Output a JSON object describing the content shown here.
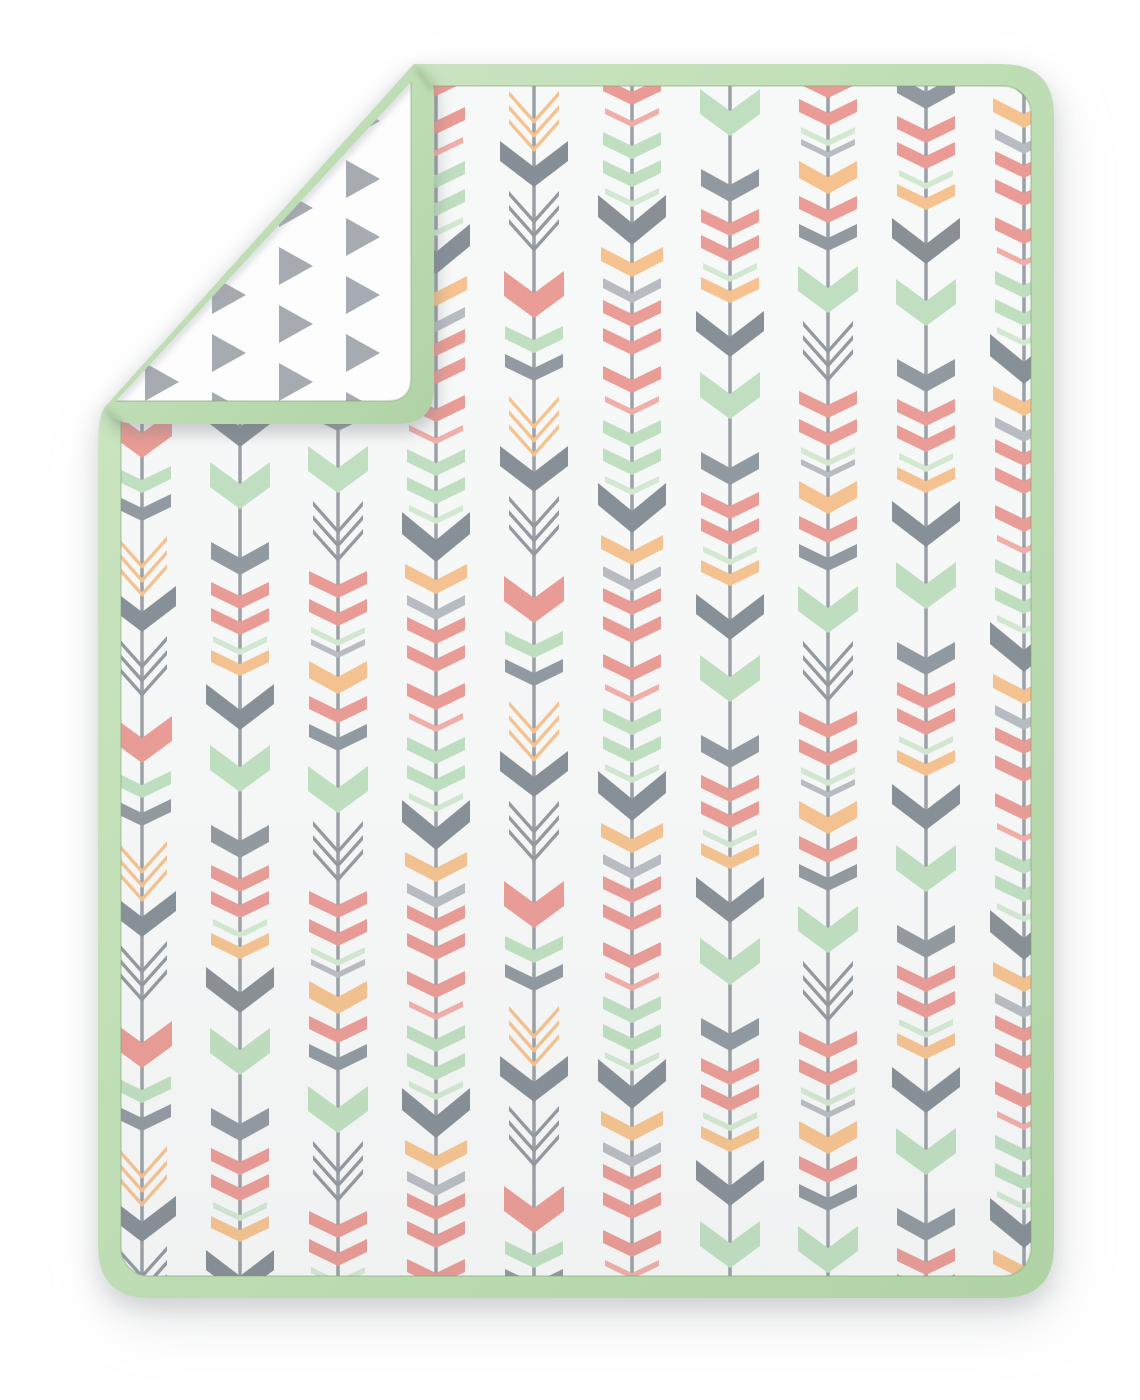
{
  "scene": {
    "background_color": "#ffffff",
    "blanket": {
      "binding_color_light": "#CEE7C4",
      "binding_color_mid": "#BEDDB4",
      "binding_color_dark": "#B0D3A6",
      "binding_seam_color": "rgba(125,155,115,0.30)",
      "front_fabric_color": "#F7F8F8",
      "front_fabric_shade": "rgba(120,126,132,0.05)",
      "back_fabric_color": "#FDFDFE",
      "crease_shadow_color": "rgba(148,154,160,0.28)",
      "fold_notch_color": "rgba(95,115,90,0.40)"
    },
    "front_pattern": {
      "shaft_color": "#9AA0A6",
      "shaft_width": 3.5,
      "palette": {
        "coral": "#EA9B95",
        "coralLine": "#F1AEA8",
        "mint": "#BFDFC0",
        "mintLine": "#D2E8D1",
        "gray": "#9199A0",
        "grayBig": "#878F96",
        "grayLight": "#B7BCC2",
        "peach": "#F5C28F"
      },
      "pattern_area": {
        "top": 86,
        "bottom": 1276
      },
      "sequences": {
        "A": {
          "period": 283,
          "motifs": [
            [
              0,
              60,
              22,
              25,
              "mint"
            ],
            [
              80,
              58,
              16,
              17,
              "gray"
            ],
            [
              120,
              58,
              14,
              13,
              "coral"
            ],
            [
              146,
              58,
              14,
              13,
              "coral"
            ],
            [
              174,
              54,
              13,
              6,
              "mintLine"
            ],
            [
              188,
              58,
              14,
              12,
              "peach"
            ],
            [
              222,
              68,
              26,
              20,
              "grayBig"
            ]
          ]
        },
        "B": {
          "period": 288,
          "motifs": [
            [
              0,
              68,
              28,
              22,
              "grayBig"
            ],
            [
              52,
              62,
              16,
              14,
              "peach"
            ],
            [
              83,
              58,
              15,
              10,
              "grayLight"
            ],
            [
              105,
              58,
              14,
              13,
              "coral"
            ],
            [
              133,
              58,
              14,
              13,
              "coral"
            ],
            [
              171,
              58,
              14,
              13,
              "coral"
            ],
            [
              201,
              54,
              13,
              6,
              "coralLine"
            ],
            [
              225,
              58,
              14,
              13,
              "mint"
            ],
            [
              253,
              58,
              14,
              13,
              "mint"
            ],
            [
              281,
              54,
              13,
              6,
              "mintLine"
            ]
          ]
        },
        "C": {
          "period": 305,
          "motifs": [
            [
              0,
              50,
              28,
              5,
              "gray"
            ],
            [
              14,
              50,
              28,
              5,
              "gray"
            ],
            [
              28,
              50,
              28,
              5,
              "gray"
            ],
            [
              80,
              60,
              22,
              25,
              "coral"
            ],
            [
              135,
              58,
              14,
              13,
              "mint"
            ],
            [
              163,
              58,
              14,
              13,
              "gray"
            ],
            [
              205,
              50,
              28,
              5,
              "peach"
            ],
            [
              219,
              50,
              28,
              5,
              "peach"
            ],
            [
              233,
              50,
              28,
              5,
              "peach"
            ],
            [
              255,
              68,
              26,
              20,
              "grayBig"
            ]
          ]
        },
        "D": {
          "period": 320,
          "motifs": [
            [
              0,
              58,
              14,
              13,
              "coral"
            ],
            [
              28,
              58,
              14,
              13,
              "gray"
            ],
            [
              70,
              60,
              22,
              25,
              "mint"
            ],
            [
              125,
              50,
              28,
              5,
              "gray"
            ],
            [
              139,
              50,
              28,
              5,
              "gray"
            ],
            [
              153,
              50,
              28,
              5,
              "gray"
            ],
            [
              195,
              58,
              14,
              13,
              "coral"
            ],
            [
              223,
              58,
              14,
              13,
              "coral"
            ],
            [
              251,
              54,
              13,
              6,
              "mintLine"
            ],
            [
              263,
              54,
              13,
              6,
              "grayLight"
            ],
            [
              285,
              58,
              16,
              17,
              "peach"
            ]
          ]
        }
      },
      "columns": [
        [
          142,
          "C",
          60
        ],
        [
          240,
          "A",
          190
        ],
        [
          338,
          "D",
          30
        ],
        [
          436,
          "B",
          150
        ],
        [
          534,
          "C",
          200
        ],
        [
          632,
          "B",
          179
        ],
        [
          730,
          "A",
          280
        ],
        [
          828,
          "D",
          210
        ],
        [
          926,
          "A",
          90
        ],
        [
          1024,
          "B",
          40
        ]
      ]
    },
    "back_pattern": {
      "triangle_color": "#A6ABB1",
      "triangle_w": 34,
      "triangle_h": 38,
      "pitch_x": 67,
      "pitch_y": 58,
      "stagger": 29,
      "grid": {
        "x0": 78,
        "y0": 44,
        "x1": 445,
        "y1": 430
      }
    }
  }
}
